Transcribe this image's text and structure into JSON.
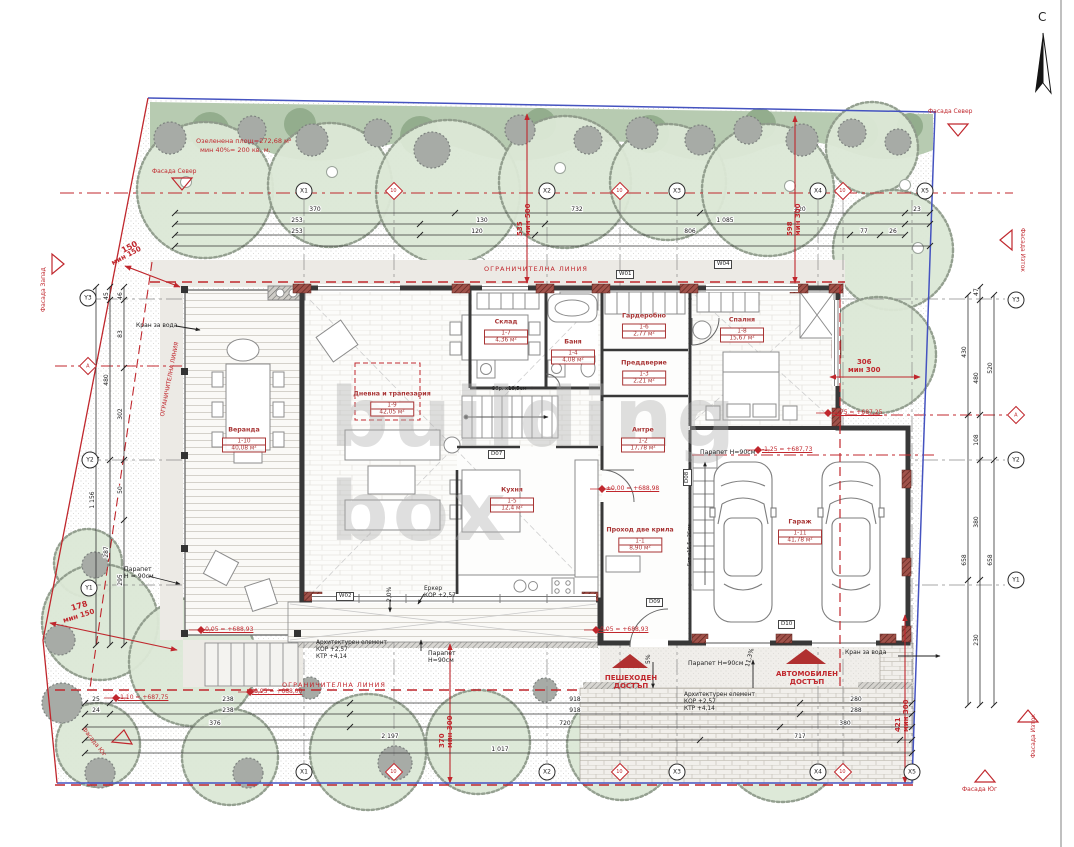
{
  "north": {
    "label": "С"
  },
  "watermark": [
    "building",
    "box"
  ],
  "texts": [
    {
      "t": "Озеленена площ=272,68 м²",
      "x": 196,
      "y": 138,
      "c": "r",
      "n": "green-area-note"
    },
    {
      "t": "мин 40%= 200 кв. м.",
      "x": 200,
      "y": 147,
      "c": "r",
      "n": "green-area-min-note"
    },
    {
      "t": "ОГРАНИЧИТЕЛНА ЛИНИЯ",
      "x": 484,
      "y": 266,
      "c": "r",
      "ls": 1,
      "n": "restriction-line-label"
    },
    {
      "t": "ОГРАНИЧИТЕЛНА ЛИНИЯ",
      "x": 282,
      "y": 682,
      "c": "r",
      "ls": 1,
      "n": "restriction-line-label"
    },
    {
      "t": "ОГРАНИЧИТЕЛНА ЛИНИЯ",
      "x": 160,
      "y": 416,
      "c": "r",
      "r": -79,
      "s": 5.8,
      "n": "restriction-line-label"
    },
    {
      "t": "Фасада Север",
      "x": 152,
      "y": 168,
      "c": "r",
      "s": 6,
      "n": "facade-north-label"
    },
    {
      "t": "Фасада Север",
      "x": 928,
      "y": 108,
      "c": "r",
      "s": 6,
      "n": "facade-north-label"
    },
    {
      "t": "Фасада Запад",
      "x": 40,
      "y": 312,
      "c": "r",
      "s": 6,
      "r": -90,
      "n": "facade-west-label"
    },
    {
      "t": "Фасада Изток",
      "x": 1026,
      "y": 228,
      "c": "r",
      "s": 6,
      "r": 90,
      "n": "facade-east-label"
    },
    {
      "t": "Фасада Изток",
      "x": 1030,
      "y": 758,
      "c": "r",
      "s": 6,
      "r": -90,
      "n": "facade-east-label"
    },
    {
      "t": "Фасада Юг",
      "x": 962,
      "y": 786,
      "c": "r",
      "s": 6,
      "n": "facade-south-label"
    },
    {
      "t": "Фасада Юг",
      "x": 86,
      "y": 726,
      "c": "r",
      "s": 6,
      "r": 52,
      "n": "facade-south-label"
    },
    {
      "t": "150",
      "x": 120,
      "y": 247,
      "c": "r",
      "s": 8,
      "b": 1,
      "r": -28,
      "n": "setback-dim"
    },
    {
      "t": "мин 150",
      "x": 110,
      "y": 260,
      "c": "r",
      "s": 7,
      "b": 1,
      "r": -28,
      "n": "setback-dim"
    },
    {
      "t": "178",
      "x": 70,
      "y": 604,
      "c": "r",
      "s": 8,
      "b": 1,
      "r": -17,
      "n": "setback-dim"
    },
    {
      "t": "мин 150",
      "x": 62,
      "y": 617,
      "c": "r",
      "s": 7,
      "b": 1,
      "r": -17,
      "n": "setback-dim"
    },
    {
      "t": "535\nмин 500",
      "x": 516,
      "y": 236,
      "c": "r",
      "s": 7,
      "b": 1,
      "r": -90,
      "n": "setback-dim"
    },
    {
      "t": "598\nмин 300",
      "x": 786,
      "y": 236,
      "c": "r",
      "s": 7,
      "b": 1,
      "r": -90,
      "n": "setback-dim"
    },
    {
      "t": "306\nмин 300",
      "x": 848,
      "y": 358,
      "c": "r",
      "s": 7,
      "b": 1,
      "ta": "center",
      "n": "setback-dim"
    },
    {
      "t": "370\nмин 300",
      "x": 438,
      "y": 748,
      "c": "r",
      "s": 7,
      "b": 1,
      "r": -90,
      "n": "setback-dim"
    },
    {
      "t": "421\nмин 300",
      "x": 894,
      "y": 732,
      "c": "r",
      "s": 7,
      "b": 1,
      "r": -90,
      "n": "setback-dim"
    },
    {
      "t": "-0,05 = +688,93",
      "x": 203,
      "y": 626,
      "c": "r",
      "s": 6,
      "u": 1,
      "n": "elevation-mark"
    },
    {
      "t": "-0,05 = +688,93",
      "x": 598,
      "y": 626,
      "c": "r",
      "s": 6,
      "u": 1,
      "n": "elevation-mark"
    },
    {
      "t": "-1,10 = +687,75",
      "x": 118,
      "y": 694,
      "c": "r",
      "s": 6,
      "u": 1,
      "n": "elevation-mark"
    },
    {
      "t": "-0,95 = +688,00",
      "x": 252,
      "y": 688,
      "c": "r",
      "s": 6,
      "u": 1,
      "n": "elevation-mark"
    },
    {
      "t": "±0,00 = +688,98",
      "x": 606,
      "y": 485,
      "c": "r",
      "s": 6,
      "u": 1,
      "n": "elevation-mark"
    },
    {
      "t": "-1,25 = +687,73",
      "x": 762,
      "y": 446,
      "c": "r",
      "s": 6,
      "u": 1,
      "n": "elevation-mark"
    },
    {
      "t": "-1,75 = +687,25",
      "x": 832,
      "y": 409,
      "c": "r",
      "s": 6,
      "u": 1,
      "n": "elevation-mark"
    },
    {
      "t": "ПЕШЕХОДЕН\nДОСТЪП",
      "x": 598,
      "y": 674,
      "c": "r",
      "s": 7,
      "b": 1,
      "ta": "center",
      "w": 66,
      "n": "pedestrian-access-label"
    },
    {
      "t": "АВТОМОБИЛЕН\nДОСТЪП",
      "x": 760,
      "y": 670,
      "c": "r",
      "s": 7,
      "b": 1,
      "ta": "center",
      "w": 94,
      "n": "car-access-label"
    },
    {
      "t": "Парапет\nН = 90см",
      "x": 124,
      "y": 566,
      "c": "k",
      "s": 6.2,
      "n": "parapet-note"
    },
    {
      "t": "Парапет Н=90см",
      "x": 700,
      "y": 449,
      "c": "k",
      "s": 6.2,
      "n": "parapet-note"
    },
    {
      "t": "Парапет\nН=90см",
      "x": 428,
      "y": 650,
      "c": "k",
      "s": 6.2,
      "n": "parapet-note"
    },
    {
      "t": "Парапет Н=90см",
      "x": 688,
      "y": 660,
      "c": "k",
      "s": 6.2,
      "n": "parapet-note"
    },
    {
      "t": "Архитектурен елемент\nКОР +2,57\nКТР +4,14",
      "x": 316,
      "y": 640,
      "c": "k",
      "s": 5.8,
      "n": "arch-element-note"
    },
    {
      "t": "Архитектурен елемент\nКОР +2,57\nКТР +4,14",
      "x": 684,
      "y": 692,
      "c": "k",
      "s": 5.8,
      "n": "arch-element-note"
    },
    {
      "t": "Еркер\nКОР +2,57",
      "x": 424,
      "y": 586,
      "c": "k",
      "s": 5.8,
      "n": "bay-window-note"
    },
    {
      "t": "Кран за вода",
      "x": 136,
      "y": 322,
      "c": "k",
      "s": 6,
      "n": "water-tap-note"
    },
    {
      "t": "Кран за вода",
      "x": 845,
      "y": 649,
      "c": "k",
      "s": 6,
      "n": "water-tap-note"
    },
    {
      "t": "11,3%",
      "x": 744,
      "y": 666,
      "c": "k",
      "s": 6,
      "r": -75,
      "n": "slope-note"
    },
    {
      "t": "5%",
      "x": 645,
      "y": 664,
      "c": "k",
      "s": 6,
      "r": -90,
      "n": "slope-note"
    },
    {
      "t": "2,0%",
      "x": 386,
      "y": 602,
      "c": "k",
      "s": 6,
      "r": -90,
      "n": "slope-note"
    },
    {
      "t": "9бр. х18,5см",
      "x": 492,
      "y": 386,
      "c": "k",
      "s": 5.2,
      "n": "stair-note"
    },
    {
      "t": "5ст.х15,5=26см",
      "x": 687,
      "y": 566,
      "c": "k",
      "s": 5,
      "r": -90,
      "n": "stair-note"
    },
    {
      "t": "W01",
      "x": 616,
      "y": 270,
      "c": "k",
      "box": 1,
      "n": "window-tag"
    },
    {
      "t": "W04",
      "x": 714,
      "y": 260,
      "c": "k",
      "box": 1,
      "n": "window-tag"
    },
    {
      "t": "W02",
      "x": 336,
      "y": 592,
      "c": "k",
      "box": 1,
      "n": "window-tag"
    },
    {
      "t": "D07",
      "x": 488,
      "y": 450,
      "c": "k",
      "box": 1,
      "n": "door-tag"
    },
    {
      "t": "D08",
      "x": 683,
      "y": 486,
      "c": "k",
      "box": 1,
      "r": -90,
      "n": "door-tag"
    },
    {
      "t": "D09",
      "x": 646,
      "y": 598,
      "c": "k",
      "box": 1,
      "n": "door-tag"
    },
    {
      "t": "D10",
      "x": 778,
      "y": 620,
      "c": "k",
      "box": 1,
      "n": "door-tag"
    }
  ],
  "rooms": [
    {
      "name": "Веранда",
      "num": "1-10",
      "area": "40,08 м²",
      "x": 244,
      "y": 440
    },
    {
      "name": "Дневна и трапезария",
      "num": "1-9",
      "area": "42,05 м²",
      "x": 392,
      "y": 404
    },
    {
      "name": "Кухня",
      "num": "1-5",
      "area": "12,4 м²",
      "x": 512,
      "y": 500
    },
    {
      "name": "Склад",
      "num": "1-7",
      "area": "4,36 м²",
      "x": 506,
      "y": 332
    },
    {
      "name": "Баня",
      "num": "1-4",
      "area": "4,08 м²",
      "x": 573,
      "y": 352
    },
    {
      "name": "Гардеробно",
      "num": "1-6",
      "area": "2,77 м²",
      "x": 644,
      "y": 326
    },
    {
      "name": "Преддверие",
      "num": "1-3",
      "area": "2,21 м²",
      "x": 644,
      "y": 373
    },
    {
      "name": "Антре",
      "num": "1-2",
      "area": "17,78 м²",
      "x": 643,
      "y": 440
    },
    {
      "name": "Проход две крила",
      "num": "1-1",
      "area": "8,90 м²",
      "x": 640,
      "y": 540
    },
    {
      "name": "Спалня",
      "num": "1-8",
      "area": "15,67 м²",
      "x": 742,
      "y": 330
    },
    {
      "name": "Гараж",
      "num": "1-11",
      "area": "41,78 м²",
      "x": 800,
      "y": 532
    }
  ],
  "bubbles": [
    {
      "label": "X1",
      "x": 304,
      "y": 191,
      "shape": "c"
    },
    {
      "label": "10",
      "x": 394,
      "y": 191,
      "shape": "d"
    },
    {
      "label": "X2",
      "x": 547,
      "y": 191,
      "shape": "c"
    },
    {
      "label": "10",
      "x": 620,
      "y": 191,
      "shape": "d"
    },
    {
      "label": "X3",
      "x": 677,
      "y": 191,
      "shape": "c"
    },
    {
      "label": "X4",
      "x": 818,
      "y": 191,
      "shape": "c"
    },
    {
      "label": "10",
      "x": 843,
      "y": 191,
      "shape": "d"
    },
    {
      "label": "X5",
      "x": 925,
      "y": 191,
      "shape": "c"
    },
    {
      "label": "X1",
      "x": 304,
      "y": 772,
      "shape": "c"
    },
    {
      "label": "10",
      "x": 394,
      "y": 772,
      "shape": "d"
    },
    {
      "label": "X2",
      "x": 547,
      "y": 772,
      "shape": "c"
    },
    {
      "label": "10",
      "x": 620,
      "y": 772,
      "shape": "d"
    },
    {
      "label": "X3",
      "x": 677,
      "y": 772,
      "shape": "c"
    },
    {
      "label": "X4",
      "x": 818,
      "y": 772,
      "shape": "c"
    },
    {
      "label": "10",
      "x": 843,
      "y": 772,
      "shape": "d"
    },
    {
      "label": "X5",
      "x": 912,
      "y": 772,
      "shape": "c"
    },
    {
      "label": "Y3",
      "x": 88,
      "y": 298,
      "shape": "c"
    },
    {
      "label": "А",
      "x": 88,
      "y": 366,
      "shape": "d"
    },
    {
      "label": "Y2",
      "x": 90,
      "y": 460,
      "shape": "c"
    },
    {
      "label": "Y1",
      "x": 89,
      "y": 588,
      "shape": "c"
    },
    {
      "label": "Y3",
      "x": 1016,
      "y": 300,
      "shape": "c"
    },
    {
      "label": "А",
      "x": 1016,
      "y": 415,
      "shape": "d"
    },
    {
      "label": "Y2",
      "x": 1016,
      "y": 460,
      "shape": "c"
    },
    {
      "label": "Y1",
      "x": 1016,
      "y": 580,
      "shape": "c"
    }
  ],
  "dims": [
    {
      "d": "h",
      "y": 213,
      "x1": 175,
      "x2": 930,
      "ticks": [
        175,
        455,
        700,
        905,
        930
      ],
      "labels": [
        {
          "x": 315,
          "t": "370"
        },
        {
          "x": 577,
          "t": "732"
        },
        {
          "x": 800,
          "t": "420"
        },
        {
          "x": 917,
          "t": "23"
        }
      ]
    },
    {
      "d": "h",
      "y": 224,
      "x1": 175,
      "x2": 930,
      "ticks": [
        175,
        420,
        545,
        905,
        930
      ],
      "labels": [
        {
          "x": 297,
          "t": "253"
        },
        {
          "x": 482,
          "t": "130"
        },
        {
          "x": 725,
          "t": "1 085"
        }
      ]
    },
    {
      "d": "h",
      "y": 235,
      "x1": 175,
      "x2": 905,
      "ticks": [
        175,
        420,
        535,
        850,
        880,
        905
      ],
      "labels": [
        {
          "x": 297,
          "t": "253"
        },
        {
          "x": 477,
          "t": "120"
        },
        {
          "x": 690,
          "t": "806"
        },
        {
          "x": 864,
          "t": "77"
        },
        {
          "x": 893,
          "t": "26"
        }
      ]
    },
    {
      "d": "h",
      "y": 246,
      "x1": 175,
      "x2": 930,
      "ticks": [
        175,
        930
      ],
      "labels": []
    },
    {
      "d": "h",
      "y": 703,
      "x1": 85,
      "x2": 912,
      "ticks": [
        85,
        110,
        350,
        800,
        912
      ],
      "labels": [
        {
          "x": 96,
          "t": "25"
        },
        {
          "x": 228,
          "t": "238"
        },
        {
          "x": 575,
          "t": "918"
        },
        {
          "x": 856,
          "t": "280"
        }
      ]
    },
    {
      "d": "h",
      "y": 714,
      "x1": 85,
      "x2": 912,
      "ticks": [
        85,
        110,
        350,
        800,
        912
      ],
      "labels": [
        {
          "x": 96,
          "t": "24"
        },
        {
          "x": 228,
          "t": "238"
        },
        {
          "x": 575,
          "t": "918"
        },
        {
          "x": 856,
          "t": "288"
        }
      ]
    },
    {
      "d": "h",
      "y": 727,
      "x1": 85,
      "x2": 912,
      "ticks": [
        85,
        350,
        780,
        912
      ],
      "labels": [
        {
          "x": 215,
          "t": "376"
        },
        {
          "x": 565,
          "t": "720"
        },
        {
          "x": 845,
          "t": "380"
        }
      ]
    },
    {
      "d": "h",
      "y": 740,
      "x1": 85,
      "x2": 912,
      "ticks": [
        85,
        700,
        900,
        912
      ],
      "labels": [
        {
          "x": 390,
          "t": "2 197"
        },
        {
          "x": 800,
          "t": "717"
        }
      ]
    },
    {
      "d": "h",
      "y": 753,
      "x1": 85,
      "x2": 912,
      "ticks": [
        85,
        912
      ],
      "labels": [
        {
          "x": 500,
          "t": "1 017"
        }
      ]
    },
    {
      "d": "v",
      "x": 96,
      "y1": 287,
      "y2": 645,
      "ticks": [
        287,
        460,
        645
      ],
      "labels": [
        {
          "y": 296,
          "t": "48"
        },
        {
          "y": 500,
          "t": "1 156"
        }
      ]
    },
    {
      "d": "v",
      "x": 110,
      "y1": 287,
      "y2": 645,
      "ticks": [
        287,
        300,
        460,
        645
      ],
      "labels": [
        {
          "y": 296,
          "t": "45"
        },
        {
          "y": 380,
          "t": "480"
        },
        {
          "y": 552,
          "t": "287"
        }
      ]
    },
    {
      "d": "v",
      "x": 124,
      "y1": 287,
      "y2": 645,
      "ticks": [
        287,
        300,
        368,
        460,
        520,
        645
      ],
      "labels": [
        {
          "y": 296,
          "t": "46"
        },
        {
          "y": 334,
          "t": "83"
        },
        {
          "y": 414,
          "t": "302"
        },
        {
          "y": 490,
          "t": "50"
        },
        {
          "y": 580,
          "t": "295"
        }
      ]
    },
    {
      "d": "v",
      "x": 968,
      "y1": 295,
      "y2": 705,
      "ticks": [
        295,
        415,
        580,
        705
      ],
      "labels": [
        {
          "y": 352,
          "t": "430"
        },
        {
          "y": 560,
          "t": "658"
        }
      ]
    },
    {
      "d": "v",
      "x": 980,
      "y1": 287,
      "y2": 705,
      "ticks": [
        287,
        300,
        415,
        460,
        580,
        705
      ],
      "labels": [
        {
          "y": 292,
          "t": "47"
        },
        {
          "y": 378,
          "t": "480"
        },
        {
          "y": 440,
          "t": "108"
        },
        {
          "y": 522,
          "t": "380"
        },
        {
          "y": 640,
          "t": "230"
        }
      ]
    },
    {
      "d": "v",
      "x": 994,
      "y1": 295,
      "y2": 705,
      "ticks": [
        295,
        460,
        705
      ],
      "labels": [
        {
          "y": 368,
          "t": "520"
        },
        {
          "y": 560,
          "t": "658"
        }
      ]
    }
  ],
  "trees": [
    [
      205,
      190,
      68,
      186,
      182
    ],
    [
      330,
      185,
      62,
      332,
      172
    ],
    [
      448,
      192,
      72,
      480,
      263
    ],
    [
      565,
      182,
      66,
      560,
      168
    ],
    [
      668,
      182,
      58
    ],
    [
      768,
      190,
      66,
      790,
      186
    ],
    [
      872,
      148,
      46,
      905,
      185
    ],
    [
      893,
      250,
      60,
      918,
      248
    ],
    [
      878,
      355,
      58
    ],
    [
      88,
      563,
      34
    ],
    [
      100,
      622,
      58,
      88,
      590
    ],
    [
      193,
      662,
      64
    ],
    [
      98,
      745,
      42
    ],
    [
      230,
      757,
      48
    ],
    [
      368,
      752,
      58
    ],
    [
      478,
      742,
      52
    ],
    [
      622,
      745,
      55,
      630,
      688
    ],
    [
      782,
      740,
      62,
      782,
      682
    ]
  ],
  "bushes": [
    [
      170,
      138,
      16
    ],
    [
      252,
      130,
      14
    ],
    [
      312,
      140,
      16
    ],
    [
      378,
      133,
      14
    ],
    [
      432,
      150,
      18
    ],
    [
      520,
      130,
      15
    ],
    [
      588,
      140,
      14
    ],
    [
      642,
      133,
      16
    ],
    [
      700,
      140,
      15
    ],
    [
      748,
      130,
      14
    ],
    [
      802,
      140,
      16
    ],
    [
      852,
      133,
      14
    ],
    [
      898,
      142,
      13
    ],
    [
      62,
      703,
      20
    ],
    [
      100,
      773,
      15
    ],
    [
      248,
      773,
      15
    ],
    [
      310,
      688,
      11
    ],
    [
      395,
      763,
      17
    ],
    [
      545,
      690,
      12
    ],
    [
      640,
      768,
      15
    ],
    [
      662,
      752,
      13
    ],
    [
      858,
      752,
      17
    ],
    [
      898,
      758,
      13
    ],
    [
      95,
      565,
      13
    ],
    [
      60,
      640,
      15
    ]
  ],
  "colors": {
    "red": "#c0272d",
    "blue": "#4553c0",
    "wall": "#383838",
    "tree_fill": "#dce8d6",
    "band": "#b7cbb1"
  }
}
